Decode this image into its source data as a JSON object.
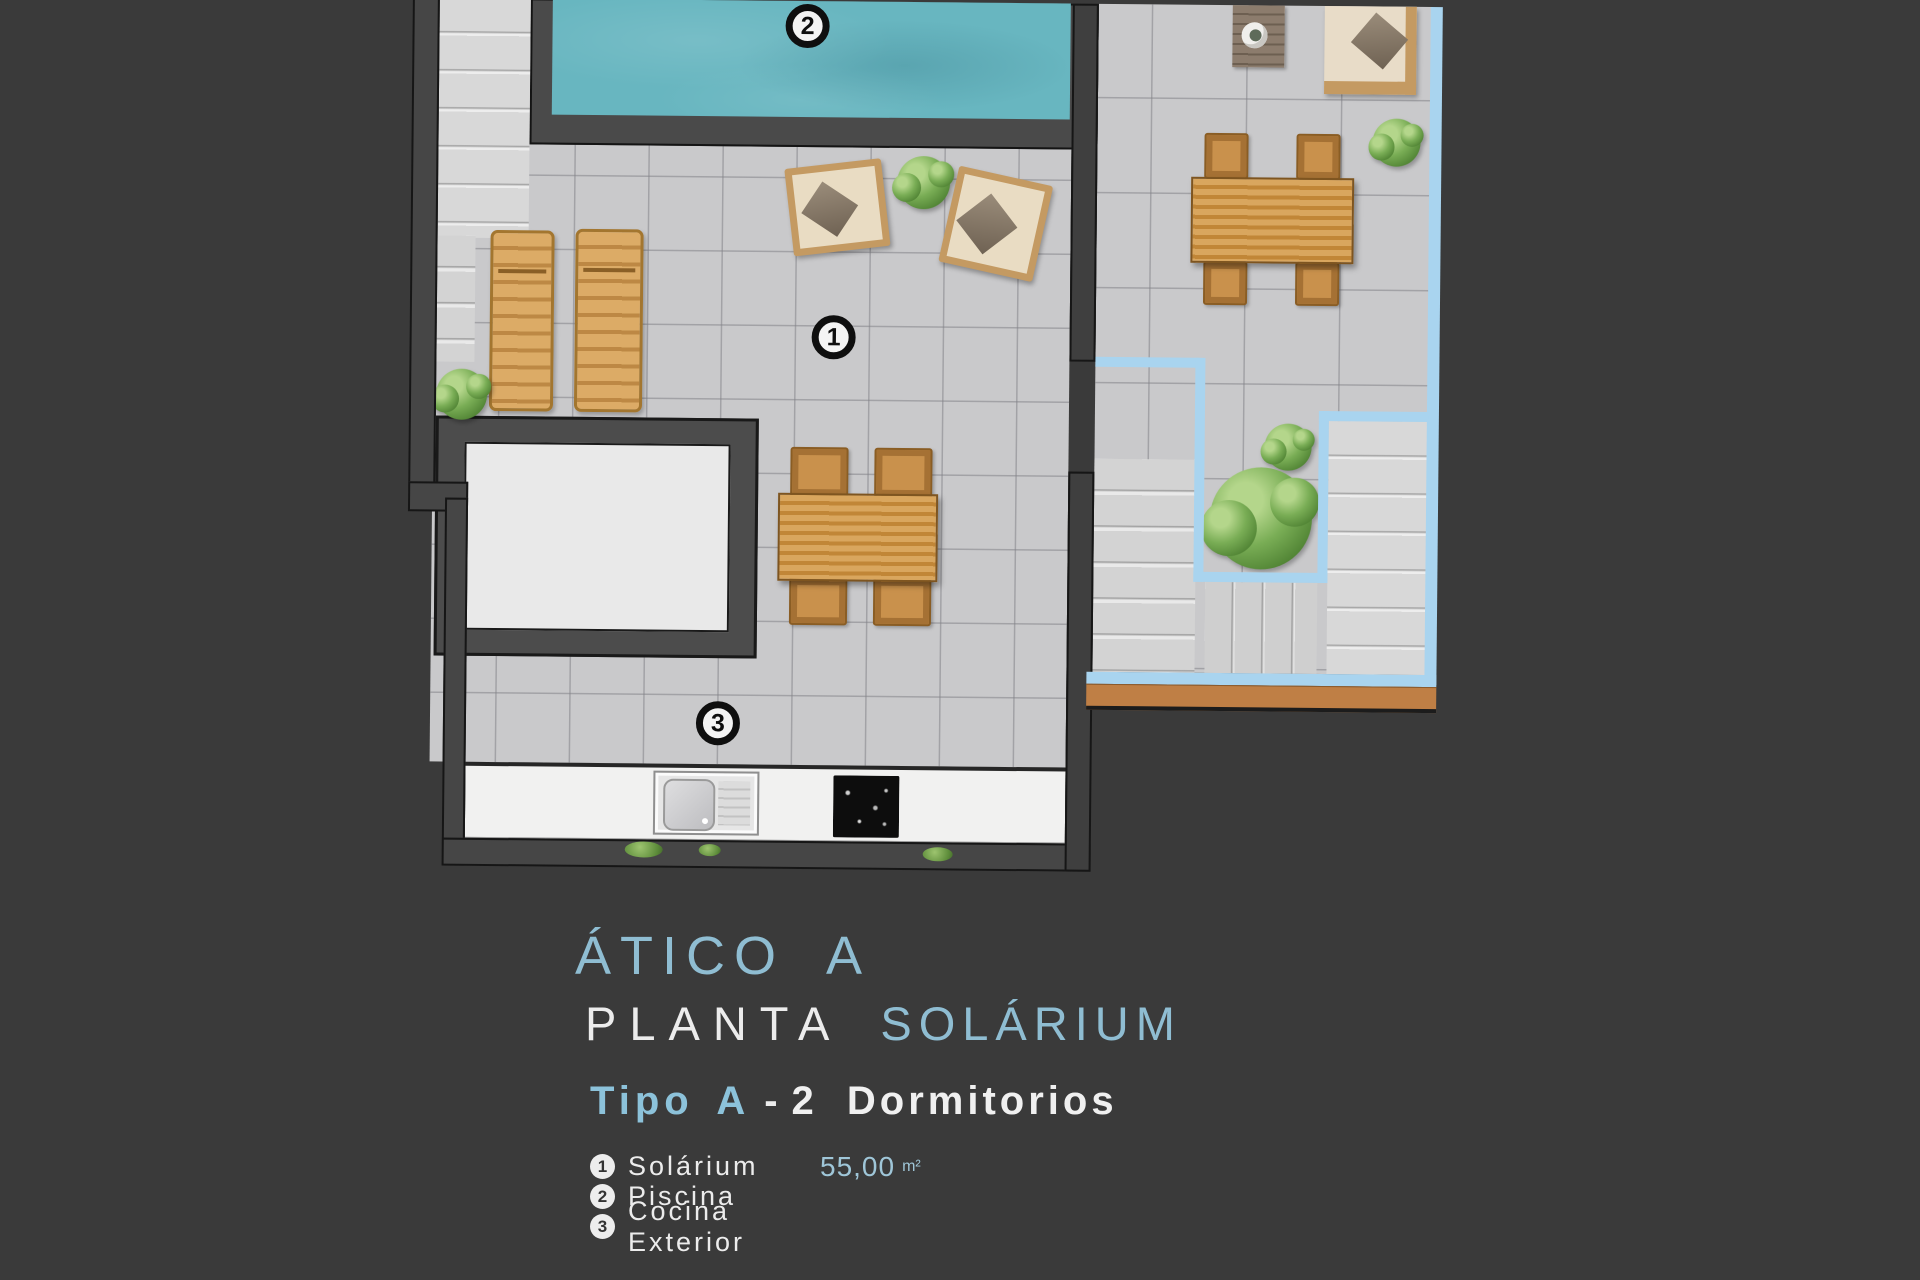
{
  "palette": {
    "background": "#3a3a3a",
    "title_blue": "#8fbdd2",
    "tipo_blue": "#8cc2da",
    "area_blue": "#9fc6d8",
    "outline_blue": "#a9d4ef",
    "pool_teal": "#68b6c0",
    "tile_gray": "#c9c9cb",
    "wood": "#cd9452",
    "white_text": "#ededed"
  },
  "title_block": {
    "line1": "ÁTICO A",
    "line2_part1": "PLANTA",
    "line2_part2": "SOLÁRIUM",
    "line3_type": "Tipo A",
    "line3_dash": "-",
    "line3_rest": "2 Dormitorios"
  },
  "legend": {
    "items": [
      {
        "num": "1",
        "label": "Solárium",
        "area": "55,00",
        "area_unit": "m²"
      },
      {
        "num": "2",
        "label": "Piscina",
        "area": "",
        "area_unit": ""
      },
      {
        "num": "3",
        "label": "Cocina Exterior",
        "area": "",
        "area_unit": ""
      }
    ]
  }
}
